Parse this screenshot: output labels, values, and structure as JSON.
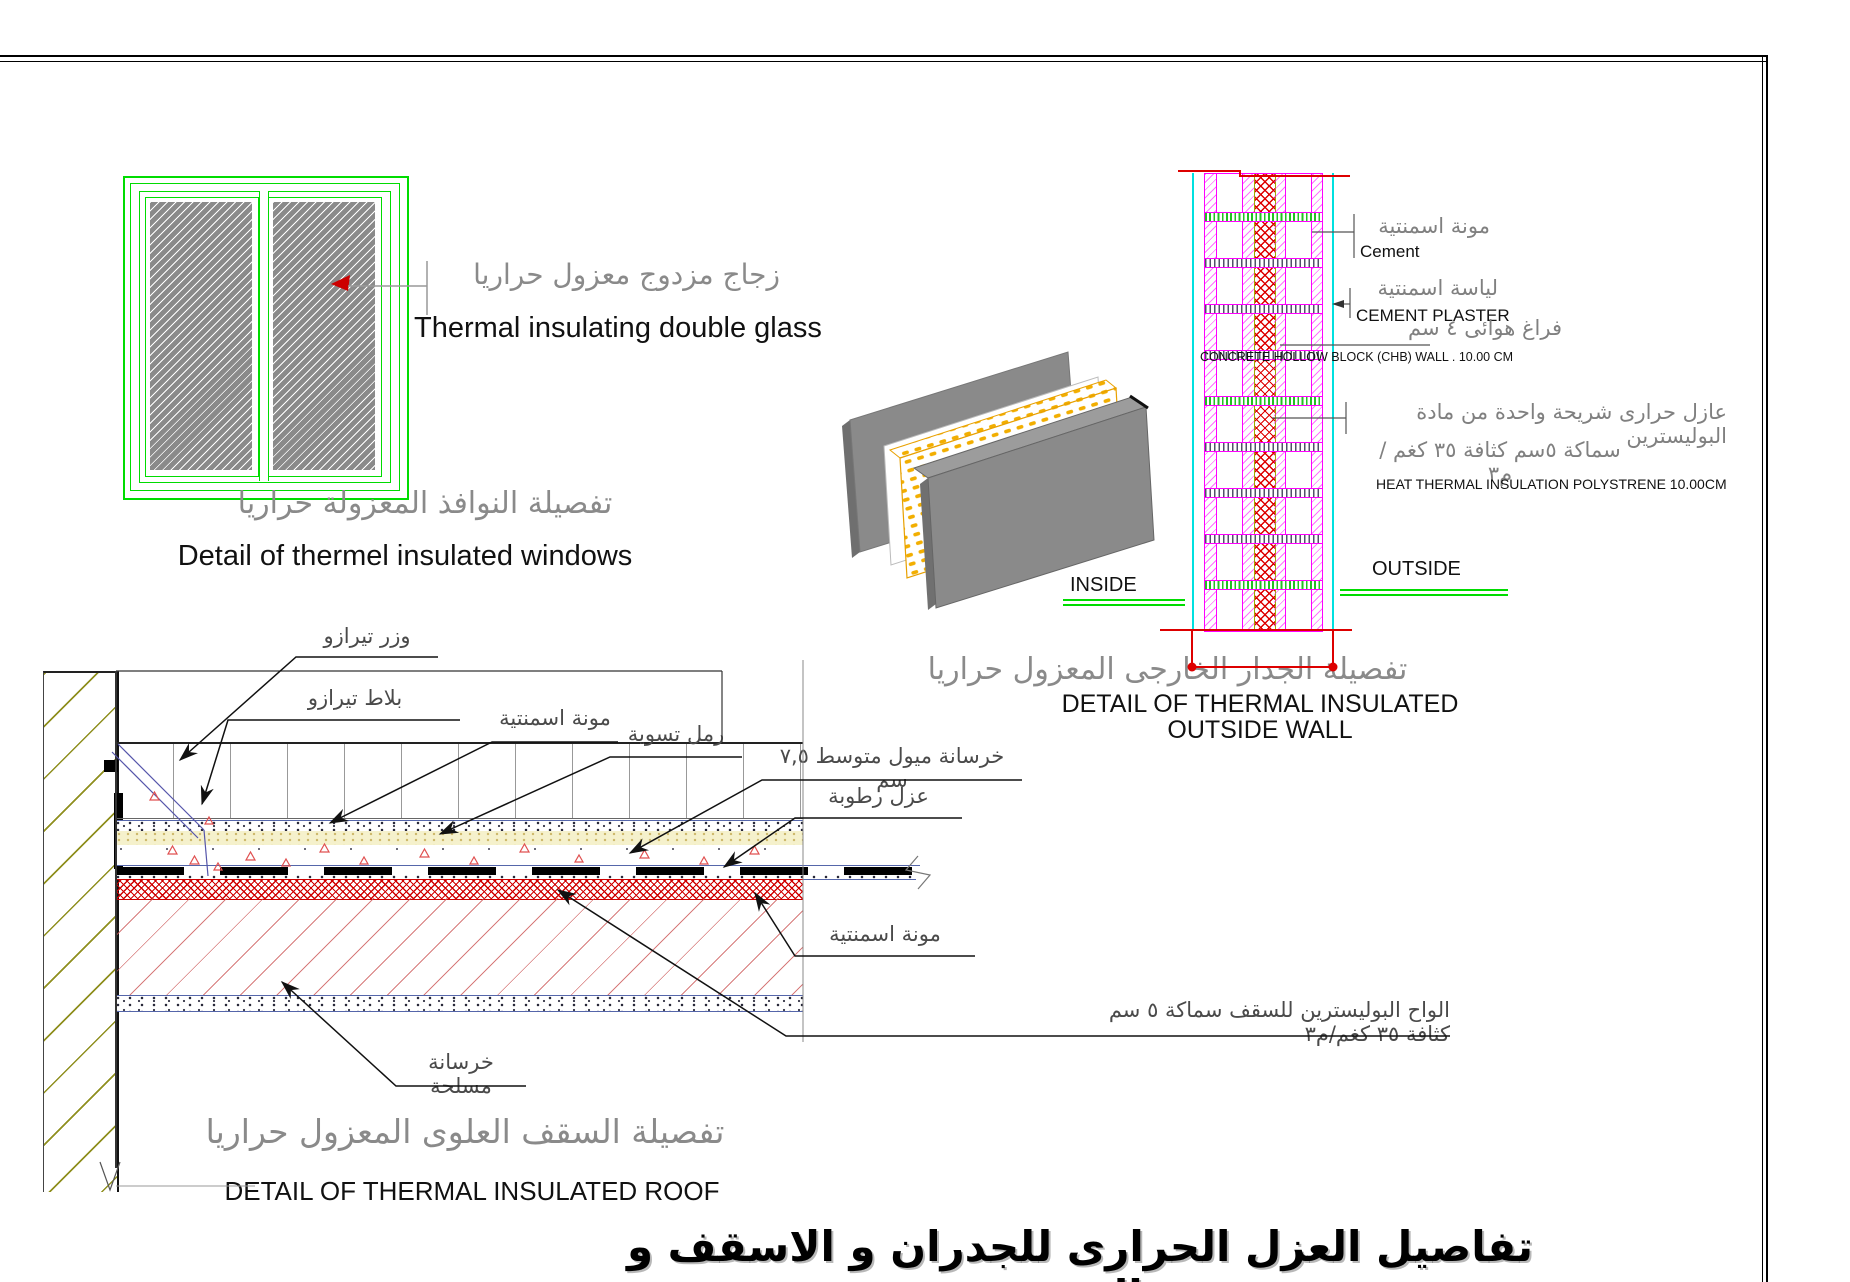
{
  "title_ar": "تفاصيل العزل الحرارى للجدران و الاسقف و النوفذ",
  "window_detail": {
    "glass_label_ar": "زجاج مزدوج معزول حراريا",
    "glass_label_en": "Thermal insulating double glass",
    "caption_ar": "تفصيلة النوافذ المعزولة حراريا",
    "caption_en": "Detail of thermel insulated windows"
  },
  "wall_detail": {
    "labels": {
      "mortar_ar": "مونة اسمنتية",
      "mortar_en": "Cement",
      "plaster_ar": "لياسة اسمنتية",
      "plaster_en": "CEMENT PLASTER",
      "airgap_ar": "فراغ هوائى ٤ سم",
      "chb_en": "CONCRETE HOLLOW BLOCK (CHB) WALL . 10.00 CM",
      "insul_ar1": "عازل حرارى شريحة واحدة من مادة البوليسترين",
      "insul_ar2": "سماكة ٥سم كثافة ٣٥ كغم /م٣",
      "insul_en": "HEAT THERMAL  INSULATION POLYSTRENE 10.00CM"
    },
    "outside": "OUTSIDE",
    "inside": "INSIDE",
    "caption_ar": "تفصيلة الجدار الخارجى المعزول حراريا",
    "caption_en_line1": "DETAIL OF THERMAL INSULATED",
    "caption_en_line2": "OUTSIDE WALL"
  },
  "roof_detail": {
    "labels": {
      "terrazzo_skirting": "وزر تيرازو",
      "terrazzo_tiles": "بلاط تيرازو",
      "cement_mortar_top": "مونة اسمنتية",
      "leveling_sand": "رمل تسوية",
      "slope_concrete": "خرسانة ميول متوسط ٧,٥ سم",
      "moisture_insulation": "عزل رطوبة",
      "cement_mortar_bottom": "مونة اسمنتية",
      "polystyrene_boards": "الواح البوليسترين للسقف سماكة ٥ سم  كثافة ٣٥ كغم/م٣",
      "reinforced_concrete": "خرسانة مسلحة"
    },
    "caption_ar": "تفصيلة السقف العلوى المعزول حراريا",
    "caption_en": "DETAIL OF THERMAL INSULATED ROOF"
  },
  "colors": {
    "frame_green": "#00DC00",
    "masonry_magenta": "#FF00FF",
    "insulation_red": "#DD0000",
    "plaster_cyan": "#00E0E0",
    "wall_hatch_olive": "#8F8F1F",
    "label_gray": "#8A8A8A"
  }
}
